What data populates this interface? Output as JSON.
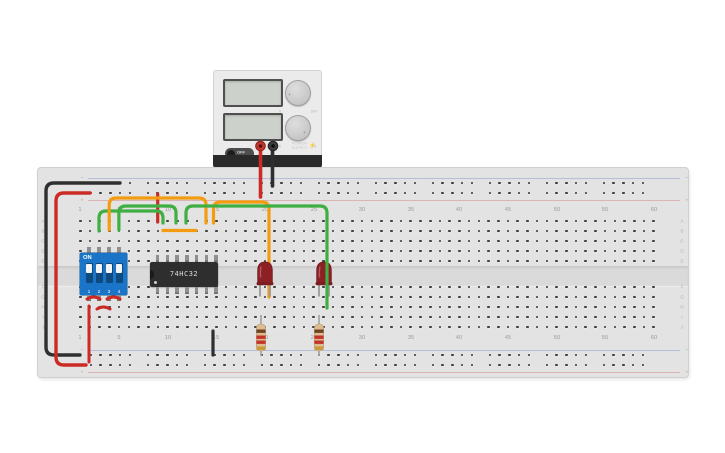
{
  "canvas_background": "#ffffff",
  "power_supply": {
    "voltage_display": "",
    "current_display": "",
    "toggle_label": "OFF",
    "brand": [
      "POWER",
      "SUPPLY"
    ],
    "bolt_icon": "⚡",
    "knob_tick": "+",
    "voltage_knob": {
      "min_label": "0",
      "max_label": "30V"
    },
    "current_knob": {
      "min_label": "0",
      "max_label": "1A"
    }
  },
  "breadboard": {
    "column_numbers": [
      "1",
      "5",
      "10",
      "15",
      "20",
      "25",
      "30",
      "35",
      "40",
      "45",
      "50",
      "55",
      "60"
    ],
    "row_letters_top_block": [
      "A",
      "B",
      "C",
      "D",
      "E"
    ],
    "row_letters_bottom_block": [
      "F",
      "G",
      "H",
      "I",
      "J"
    ],
    "rail_negative_sign": "−",
    "rail_positive_sign": "+",
    "rail_negative_color": "#5b79c9",
    "rail_positive_color": "#c95b5b"
  },
  "components": {
    "dip_switch": {
      "on_label": "ON",
      "switch_numbers": [
        "1",
        "2",
        "3",
        "4"
      ],
      "body_color": "#1a74c8"
    },
    "ic_chip": {
      "part_number": "74HC32",
      "body_color": "#2e2e2e"
    },
    "led_1": {
      "color": "#8d2025",
      "state": "off"
    },
    "led_2": {
      "color": "#8d2025",
      "state": "off"
    },
    "resistor_1": {
      "band_colors": [
        "#6d4426",
        "#c4342b",
        "#c4342b",
        "#c79b3b"
      ],
      "body_color": "#dcbd92"
    },
    "resistor_2": {
      "band_colors": [
        "#6d4426",
        "#c4342b",
        "#c4342b",
        "#c79b3b"
      ],
      "body_color": "#dcbd92"
    }
  },
  "wires": {
    "red": "#cc2a24",
    "black": "#2f2f2f",
    "green": "#3fae43",
    "orange": "#f39c12"
  }
}
